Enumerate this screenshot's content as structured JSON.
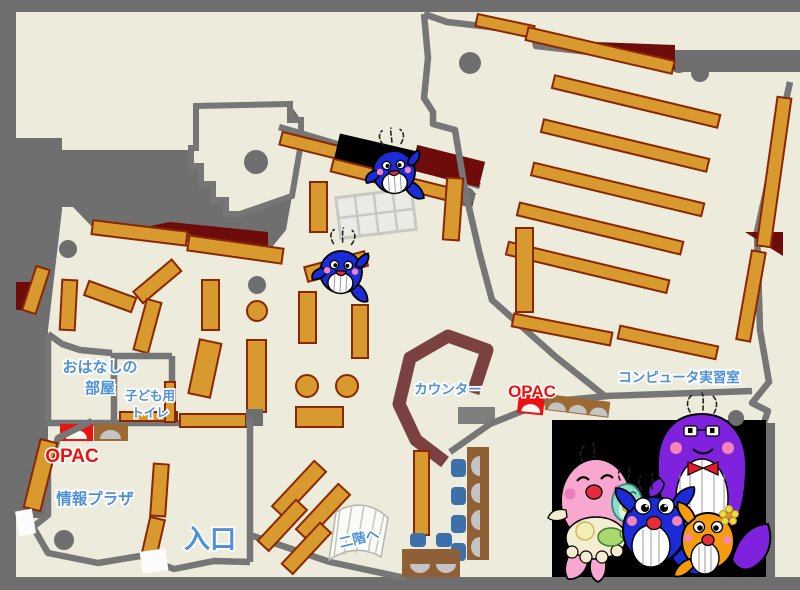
{
  "map": {
    "title": "library-first-floor-map",
    "labels": {
      "storytelling_room_line1": "おはなしの",
      "storytelling_room_line2": "部屋",
      "kids_toilet_line1": "子ども用",
      "kids_toilet_line2": "トイレ",
      "counter": "カウンター",
      "opac_left": "OPAC",
      "opac_right": "OPAC",
      "computer_room": "コンピュータ実習室",
      "info_plaza": "情報プラザ",
      "entrance": "入口",
      "to_second_floor": "二階へ"
    },
    "colors": {
      "floor": "#EDEBDB",
      "frame": "#6E6E6E",
      "wall": "#767676",
      "mass": "#6F6F6F",
      "shelf": "#D8992F",
      "shelfBorder": "#8B2703",
      "darkRed": "#6E0B0B",
      "counter": "#7B4141",
      "black": "#000000",
      "labelBlue": "#4E90D9",
      "labelRed": "#EE1111",
      "chairBlue": "#3D6FA8",
      "deskBrown": "#8F5F35",
      "humpGray": "#C4C4C4",
      "pillar": "#6E6E6E",
      "whaleBlue": "#1C2BD8",
      "pinkWhale": "#F8A8D0",
      "purpleWhale": "#7E22DD",
      "orangeWhale": "#F59B10",
      "tealBaby": "#8ADBC8"
    }
  }
}
